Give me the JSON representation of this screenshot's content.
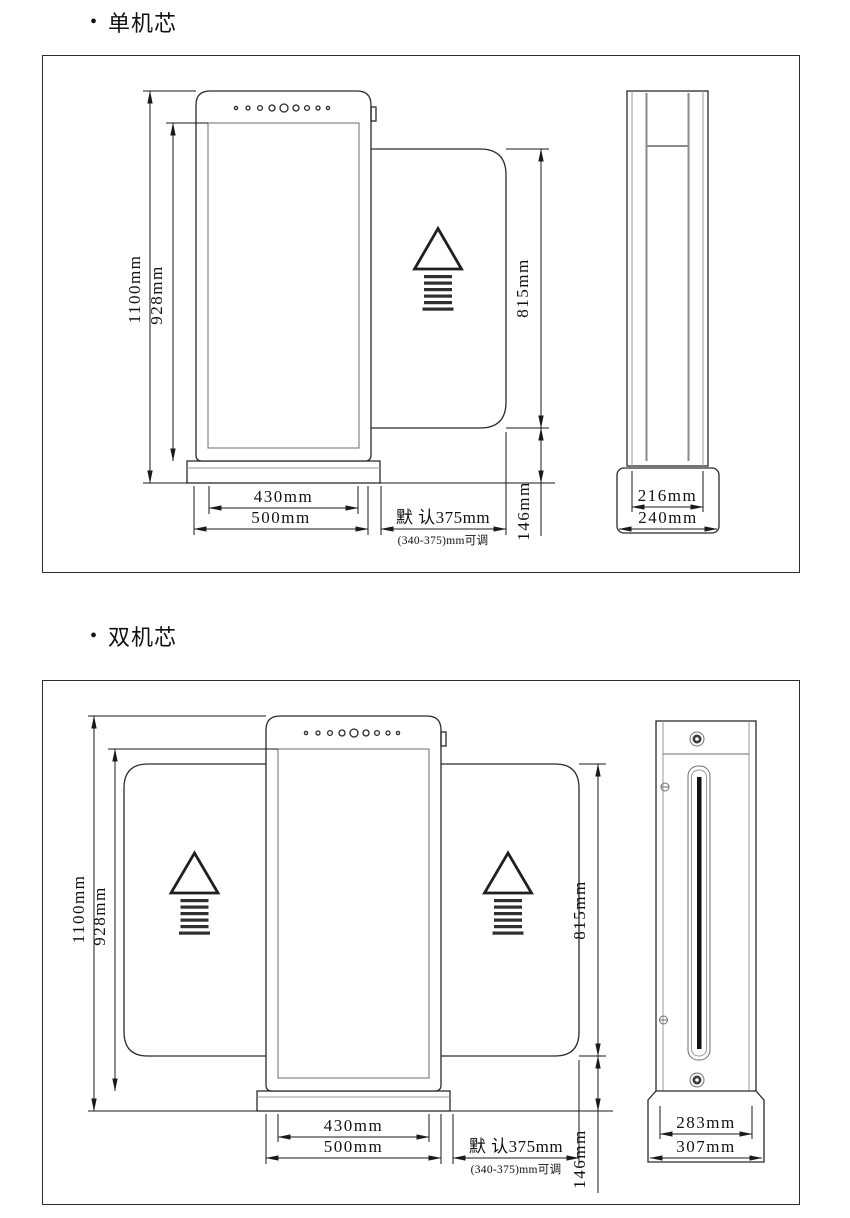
{
  "page": {
    "background": "#ffffff",
    "line_color": "#1a1a1a"
  },
  "sections": [
    {
      "id": "single-core",
      "bullet": "•",
      "title": "单机芯",
      "dims": {
        "total_height": "1100mm",
        "body_height": "928mm",
        "flap_height": "815mm",
        "bottom_gap": "146mm",
        "inner_width": "430mm",
        "outer_width": "500mm",
        "flap_default": "默 认375mm",
        "flap_range": "(340-375)mm可调",
        "depth_inner": "216mm",
        "depth_outer": "240mm"
      }
    },
    {
      "id": "dual-core",
      "bullet": "•",
      "title": "双机芯",
      "dims": {
        "total_height": "1100mm",
        "body_height": "928mm",
        "flap_height": "815mm",
        "bottom_gap": "146mm",
        "inner_width": "430mm",
        "outer_width": "500mm",
        "flap_default": "默 认375mm",
        "flap_range": "(340-375)mm可调",
        "depth_inner": "283mm",
        "depth_outer": "307mm"
      }
    }
  ]
}
